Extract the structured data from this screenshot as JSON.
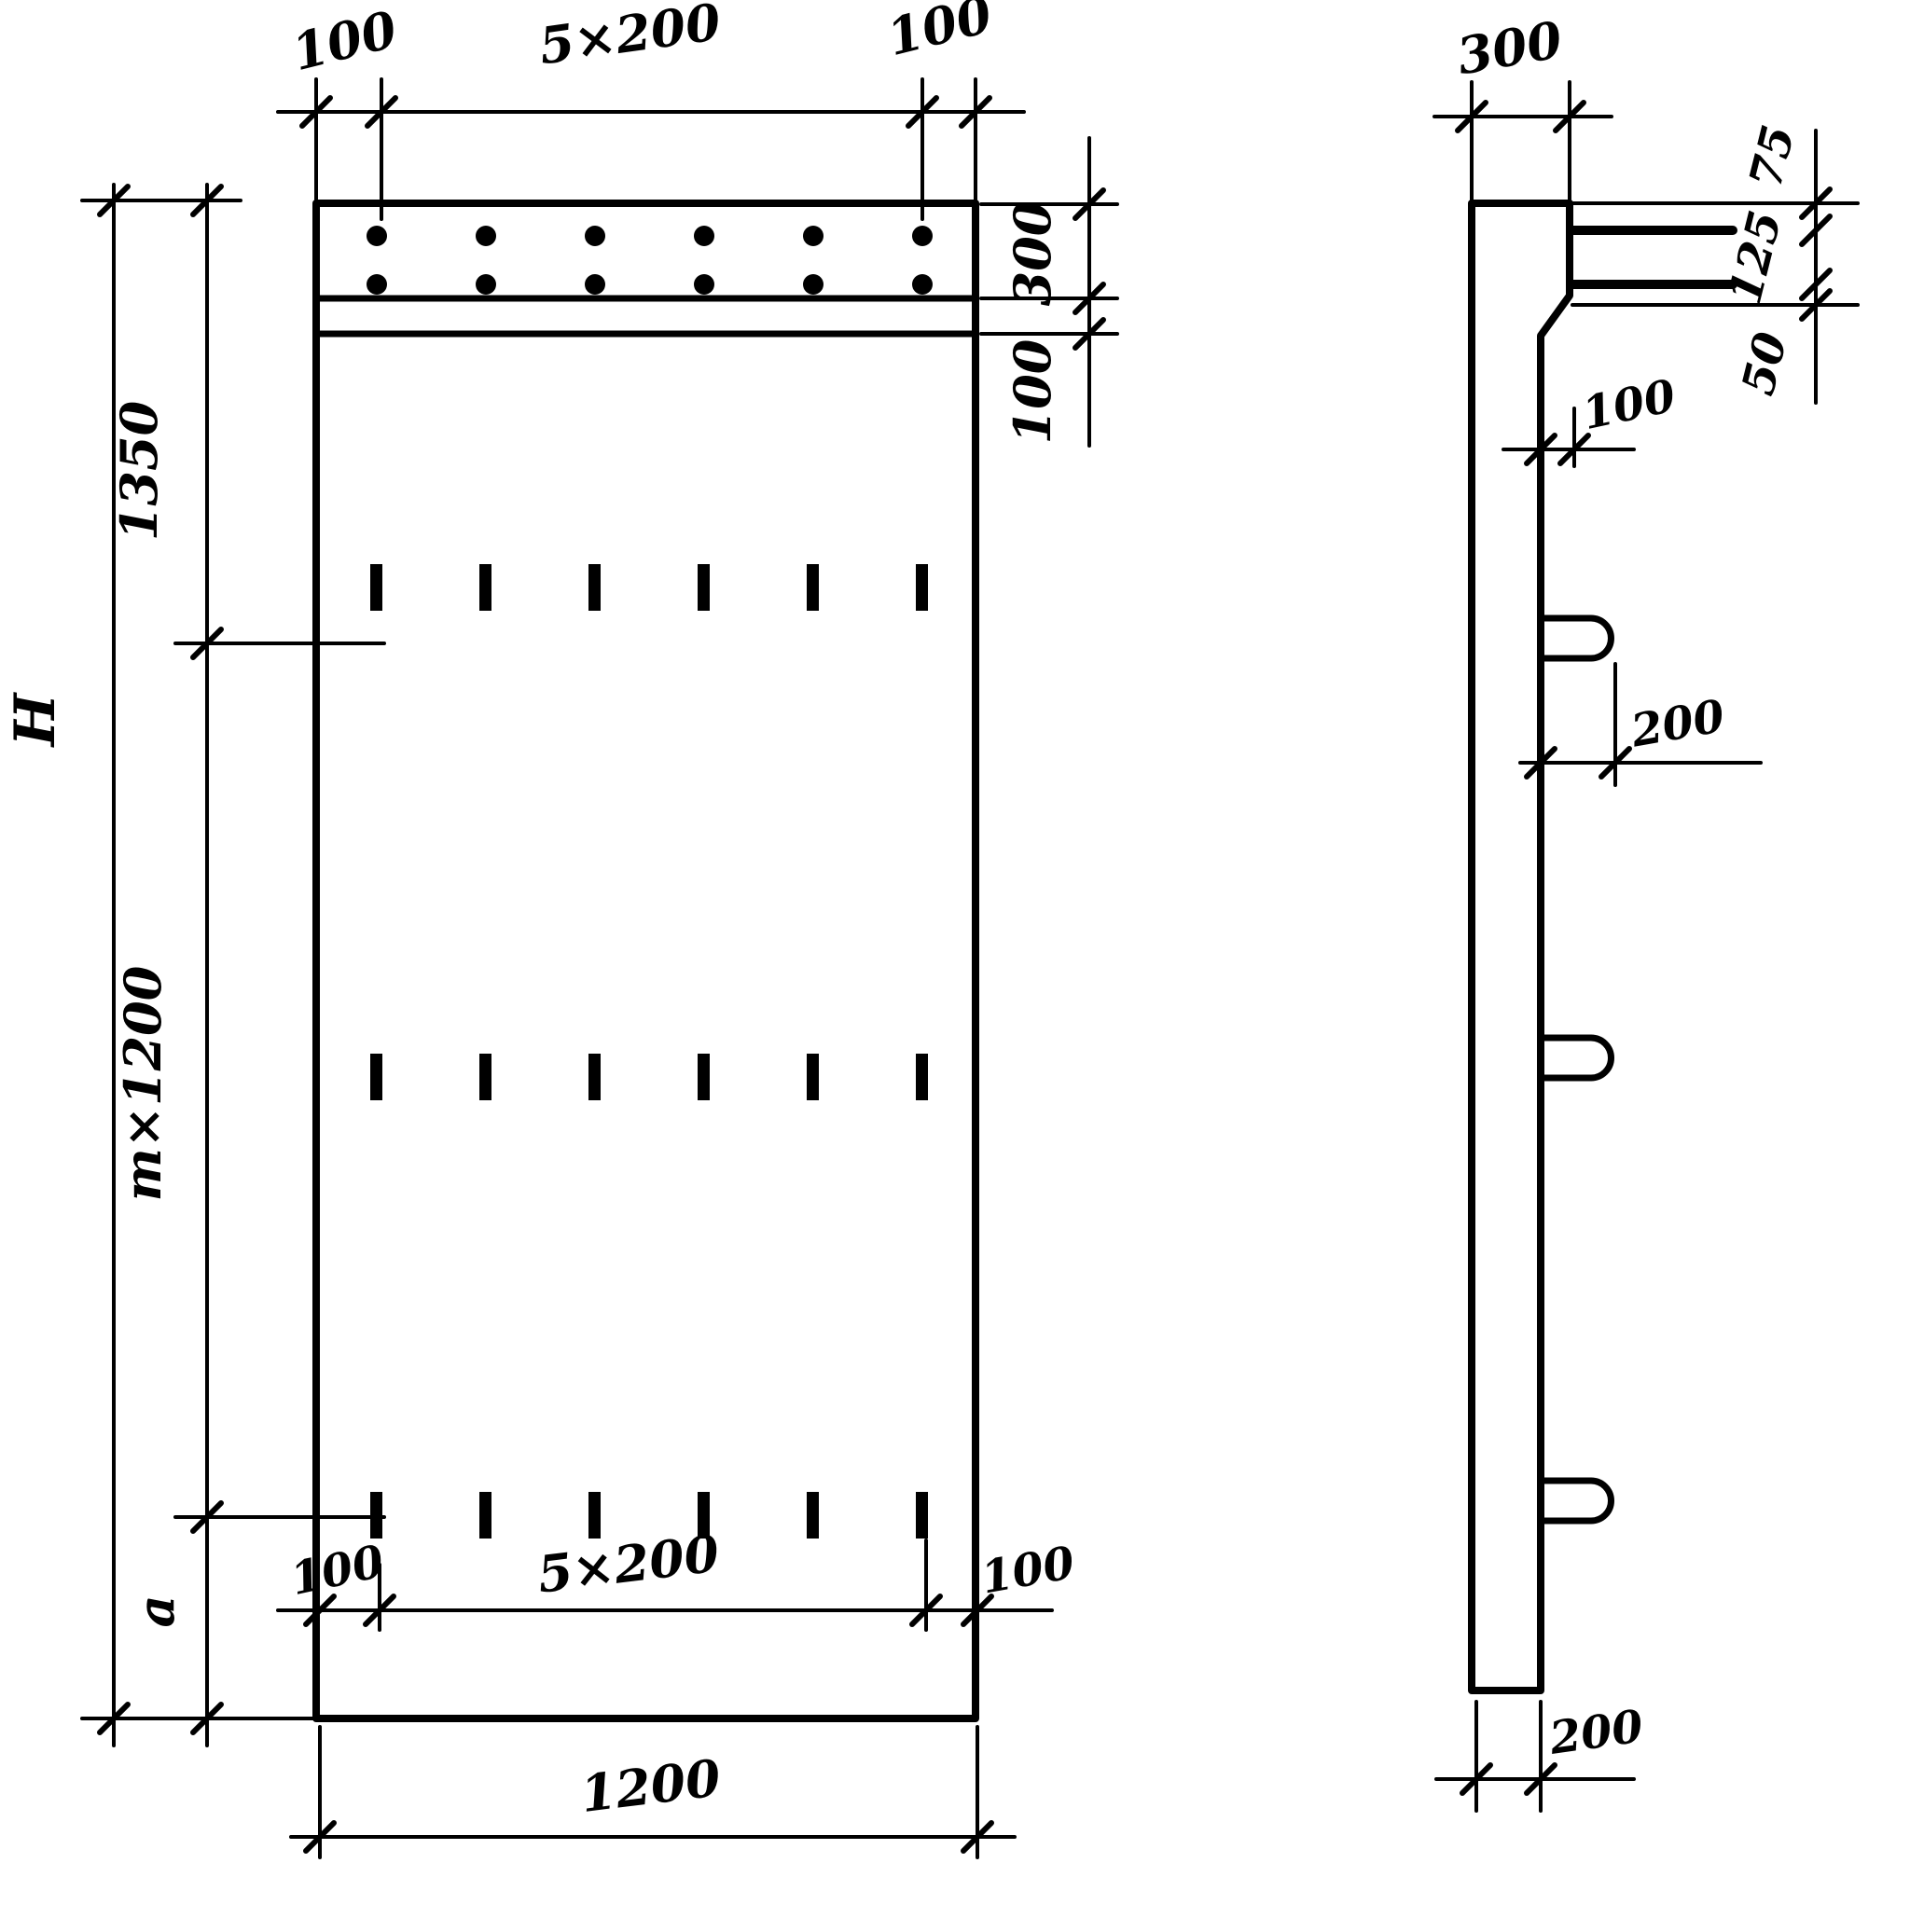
{
  "front_view": {
    "top_dims": {
      "left_margin": "100",
      "spacing": "5×200",
      "right_margin": "100"
    },
    "right_dims": {
      "band_height": "300",
      "band_offset": "100"
    },
    "left_dims": {
      "upper": "1350",
      "overall": "H",
      "middle": "m×1200",
      "lower": "a"
    },
    "bottom_inner_dims": {
      "left_margin": "100",
      "spacing": "5×200",
      "right_margin": "100"
    },
    "bottom_dims": {
      "overall_width": "1200"
    }
  },
  "side_view": {
    "top_dims": {
      "thickness": "300"
    },
    "right_chain_dims": {
      "top": "75",
      "middle": "125",
      "bottom": "50"
    },
    "bar_offset_dim": "100",
    "loop_length_dim": "200",
    "bottom_thickness_dim": "200"
  }
}
